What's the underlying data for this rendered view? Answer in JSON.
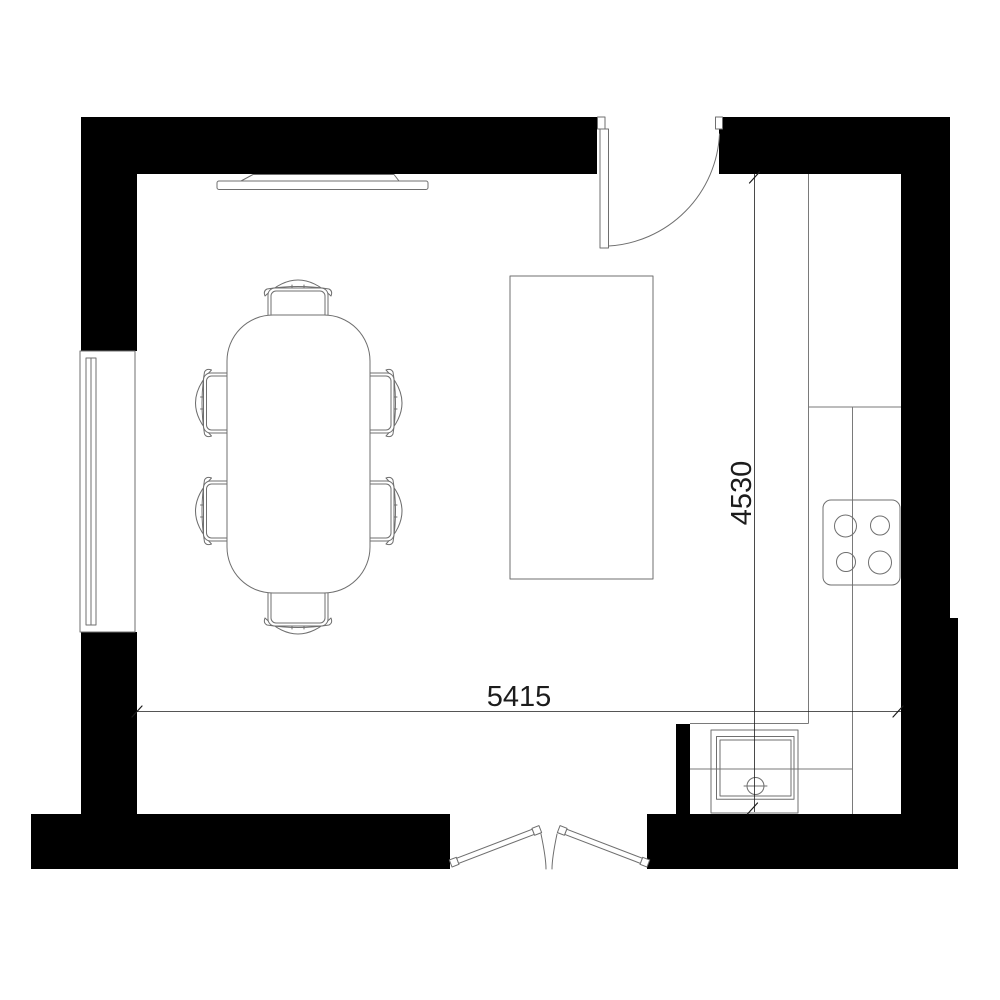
{
  "colors": {
    "background": "#ffffff",
    "wall": "#000000",
    "furniture_line": "#6f6f6f",
    "counter_line": "#7a7a7a",
    "dimension": "#1c1c1c"
  },
  "dimensions": {
    "width_label": "5415",
    "height_label": "4530"
  },
  "elements": [
    {
      "name": "exterior-walls"
    },
    {
      "name": "window-left"
    },
    {
      "name": "swing-door-top-right"
    },
    {
      "name": "double-door-bottom"
    },
    {
      "name": "wall-mounted-tv"
    },
    {
      "name": "dining-table"
    },
    {
      "name": "dining-chairs",
      "count": 6
    },
    {
      "name": "kitchen-island"
    },
    {
      "name": "counter-right"
    },
    {
      "name": "cooktop",
      "burners": 4
    },
    {
      "name": "sink"
    },
    {
      "name": "dimension-width"
    },
    {
      "name": "dimension-height"
    }
  ]
}
